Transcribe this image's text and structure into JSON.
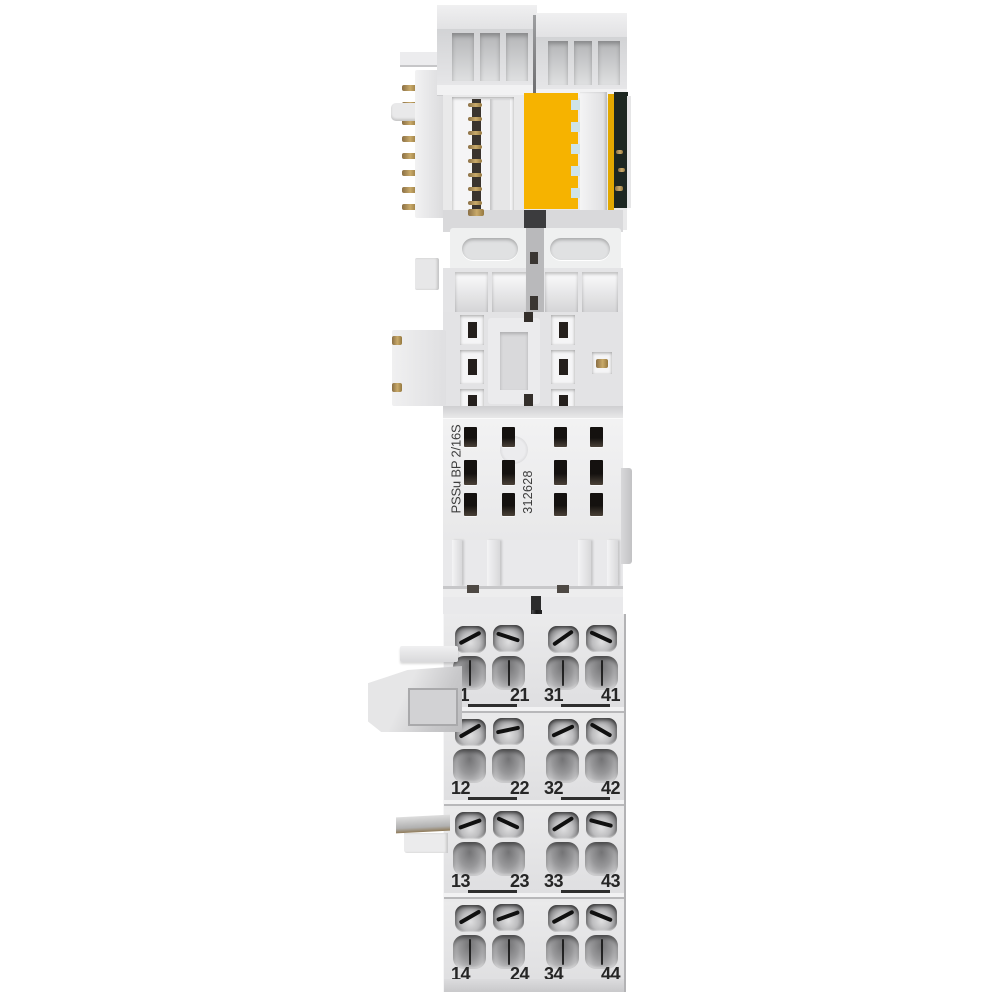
{
  "module": {
    "product_label": "PSSu BP 2/16S",
    "part_number": "312628",
    "terminal_labels": {
      "rows": [
        [
          "11",
          "21",
          "31",
          "41"
        ],
        [
          "12",
          "22",
          "32",
          "42"
        ],
        [
          "13",
          "23",
          "33",
          "43"
        ],
        [
          "14",
          "24",
          "34",
          "44"
        ]
      ]
    },
    "colors": {
      "background": "#FFFFFF",
      "plastic_light": "#ECECED",
      "plastic_mid": "#E2E2E4",
      "plastic_shadow": "#BDBDBF",
      "accent_yellow": "#F6B300",
      "accent_yellow_dark": "#E2A800",
      "pcb_dark_green": "#1D2721",
      "contact_gold": "#A8894E",
      "label_text": "#3C3C3C",
      "terminal_number_text": "#262626",
      "divider_dark": "#2E2E2E"
    }
  }
}
